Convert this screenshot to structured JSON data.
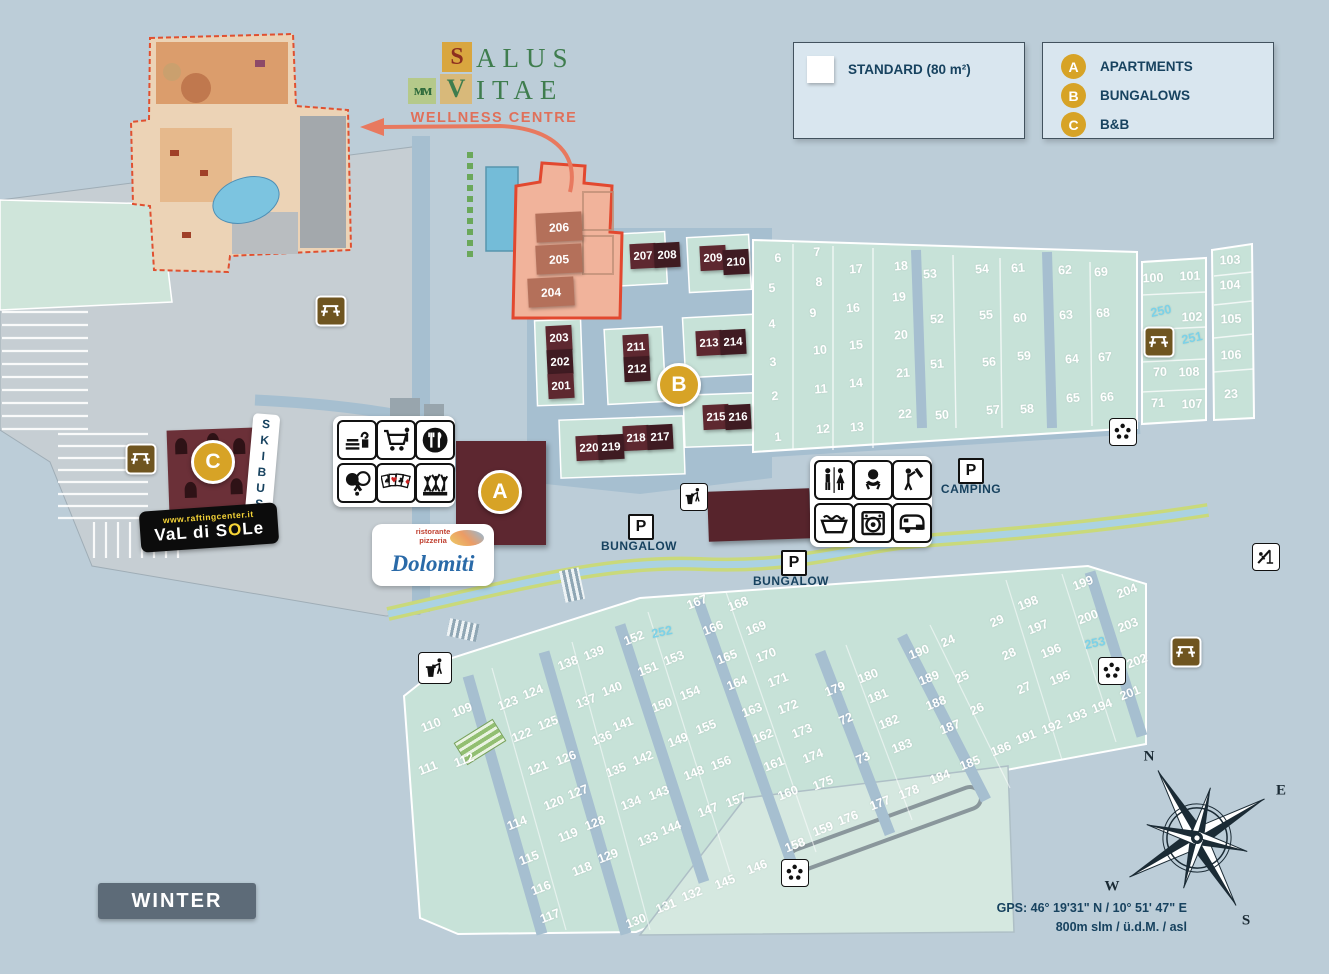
{
  "title": {
    "word1": "ALUS",
    "word2": "ITAE",
    "s_letter": "S",
    "v_letter": "V",
    "m_letter": "ᴍᴍ",
    "sub": "WELLNESS CENTRE"
  },
  "legend": {
    "standard_label": "STANDARD (80 m²)",
    "entries": [
      {
        "key": "A",
        "label": "APARTMENTS"
      },
      {
        "key": "B",
        "label": "BUNGALOWS"
      },
      {
        "key": "C",
        "label": "B&B"
      }
    ]
  },
  "markers": {
    "a": "A",
    "b": "B",
    "c": "C"
  },
  "labels": {
    "skibus": "SKIBUS",
    "camping": "CAMPING",
    "bungalow_left": "BUNGALOW",
    "bungalow_right": "BUNGALOW",
    "winter": "WINTER",
    "parking": "P"
  },
  "gps": {
    "line1": "GPS:  46° 19'31\" N / 10° 51' 47\" E",
    "line2": "800m slm / ü.d.M. / asl"
  },
  "brands": {
    "rafting_url": "www.raftingcenter.it",
    "rafting_name_pre": "VaL di S",
    "rafting_o": "O",
    "rafting_name_post": "Le",
    "restaurant_pre": "ristorante",
    "restaurant_pre2": "pizzeria",
    "restaurant_name": "Dolomiti"
  },
  "compass": {
    "n": "N",
    "e": "E",
    "s": "S",
    "w": "W"
  },
  "colors": {
    "accent_gold": "#d7a326",
    "building_dark": "#5e2830",
    "building_darker": "#3f1b22",
    "building_light": "#b4705a",
    "pitch_green": "#c7e2d8",
    "cyan_number": "#7bd2e8",
    "navy": "#17425f",
    "salmon_area": "#f1b39b",
    "red_outline": "#e2482f"
  },
  "service_icons": [
    "dishwashing",
    "market",
    "restaurant",
    "table-tennis",
    "playing-cards",
    "entertainment"
  ],
  "sanitary_icons": [
    "wc",
    "baby-room",
    "shower",
    "washing-sinks",
    "laundry",
    "camper-service"
  ],
  "map_icons": [
    {
      "type": "picnic-table",
      "x": 331,
      "y": 311
    },
    {
      "type": "picnic-table",
      "x": 141,
      "y": 459
    },
    {
      "type": "picnic-table",
      "x": 1159,
      "y": 342
    },
    {
      "type": "picnic-table",
      "x": 1186,
      "y": 652
    },
    {
      "type": "waste",
      "x": 435,
      "y": 668,
      "big": true
    },
    {
      "type": "waste",
      "x": 694,
      "y": 497
    },
    {
      "type": "recycle",
      "x": 1123,
      "y": 432
    },
    {
      "type": "recycle",
      "x": 1112,
      "y": 671
    },
    {
      "type": "recycle",
      "x": 795,
      "y": 873
    },
    {
      "type": "playground",
      "x": 1266,
      "y": 557
    }
  ],
  "buildings": {
    "wellness": [
      [
        "206",
        559,
        227
      ],
      [
        "205",
        559,
        259
      ],
      [
        "204",
        551,
        292
      ]
    ],
    "bungalows": [
      [
        "207",
        643,
        256,
        "a"
      ],
      [
        "208",
        667,
        255,
        "b"
      ],
      [
        "209",
        713,
        258,
        "a"
      ],
      [
        "210",
        736,
        262,
        "b"
      ],
      [
        "203",
        559,
        338,
        "a"
      ],
      [
        "202",
        560,
        362,
        "b"
      ],
      [
        "201",
        561,
        386,
        "a"
      ],
      [
        "211",
        636,
        347,
        "a"
      ],
      [
        "212",
        637,
        369,
        "b"
      ],
      [
        "213",
        709,
        343,
        "a"
      ],
      [
        "214",
        733,
        342,
        "b"
      ],
      [
        "215",
        716,
        417,
        "a"
      ],
      [
        "216",
        738,
        417,
        "b"
      ],
      [
        "218",
        636,
        438,
        "a"
      ],
      [
        "217",
        660,
        437,
        "b"
      ],
      [
        "220",
        589,
        448,
        "a"
      ],
      [
        "219",
        611,
        447,
        "b"
      ]
    ]
  },
  "pitch_groups": [
    {
      "id": "top",
      "rot": -4,
      "items": [
        [
          "6",
          778,
          258
        ],
        [
          "7",
          817,
          252
        ],
        [
          "17",
          856,
          269
        ],
        [
          "18",
          901,
          266
        ],
        [
          "53",
          930,
          274
        ],
        [
          "5",
          772,
          288
        ],
        [
          "8",
          819,
          282
        ],
        [
          "16",
          853,
          308
        ],
        [
          "19",
          899,
          297
        ],
        [
          "52",
          937,
          319
        ],
        [
          "4",
          772,
          324
        ],
        [
          "9",
          813,
          313
        ],
        [
          "15",
          856,
          345
        ],
        [
          "20",
          901,
          335
        ],
        [
          "3",
          773,
          362
        ],
        [
          "10",
          820,
          350
        ],
        [
          "14",
          856,
          383
        ],
        [
          "21",
          903,
          373
        ],
        [
          "51",
          937,
          364
        ],
        [
          "2",
          775,
          396
        ],
        [
          "11",
          821,
          389
        ],
        [
          "22",
          905,
          414
        ],
        [
          "50",
          942,
          415
        ],
        [
          "1",
          778,
          437
        ],
        [
          "12",
          823,
          429
        ],
        [
          "13",
          857,
          427
        ],
        [
          "54",
          982,
          269
        ],
        [
          "61",
          1018,
          268
        ],
        [
          "62",
          1065,
          270
        ],
        [
          "69",
          1101,
          272
        ],
        [
          "55",
          986,
          315
        ],
        [
          "60",
          1020,
          318
        ],
        [
          "63",
          1066,
          315
        ],
        [
          "68",
          1103,
          313
        ],
        [
          "56",
          989,
          362
        ],
        [
          "59",
          1024,
          356
        ],
        [
          "64",
          1072,
          359
        ],
        [
          "67",
          1105,
          357
        ],
        [
          "57",
          993,
          410
        ],
        [
          "58",
          1027,
          409
        ],
        [
          "65",
          1073,
          398
        ],
        [
          "66",
          1107,
          397
        ]
      ]
    },
    {
      "id": "right",
      "rot": -2,
      "items": [
        [
          "100",
          1153,
          278
        ],
        [
          "101",
          1190,
          276
        ],
        [
          "103",
          1230,
          260
        ],
        [
          "104",
          1230,
          285
        ],
        [
          "102",
          1192,
          317
        ],
        [
          "105",
          1231,
          319
        ],
        [
          "106",
          1231,
          355
        ],
        [
          "70",
          1160,
          372
        ],
        [
          "108",
          1189,
          372
        ],
        [
          "23",
          1231,
          394
        ],
        [
          "71",
          1158,
          403
        ],
        [
          "107",
          1192,
          404
        ]
      ]
    },
    {
      "id": "mid",
      "rot": -24,
      "items": [
        [
          "29",
          997,
          621
        ],
        [
          "28",
          1009,
          654
        ],
        [
          "27",
          1024,
          688
        ],
        [
          "26",
          977,
          709
        ],
        [
          "25",
          962,
          677
        ],
        [
          "24",
          948,
          641
        ],
        [
          "72",
          846,
          719
        ],
        [
          "73",
          863,
          758
        ]
      ]
    },
    {
      "id": "bottom",
      "rot": -21,
      "items": [
        [
          "109",
          462,
          710
        ],
        [
          "110",
          431,
          725
        ],
        [
          "111",
          428,
          768
        ],
        [
          "112",
          464,
          760
        ],
        [
          "114",
          517,
          823
        ],
        [
          "115",
          529,
          858
        ],
        [
          "116",
          541,
          888
        ],
        [
          "117",
          550,
          916
        ],
        [
          "118",
          582,
          869
        ],
        [
          "119",
          568,
          835
        ],
        [
          "120",
          554,
          803
        ],
        [
          "121",
          538,
          768
        ],
        [
          "122",
          522,
          735
        ],
        [
          "123",
          508,
          703
        ],
        [
          "124",
          533,
          692
        ],
        [
          "125",
          548,
          723
        ],
        [
          "126",
          566,
          758
        ],
        [
          "127",
          578,
          792
        ],
        [
          "128",
          595,
          823
        ],
        [
          "129",
          608,
          856
        ],
        [
          "130",
          636,
          921
        ],
        [
          "131",
          666,
          906
        ],
        [
          "132",
          692,
          894
        ],
        [
          "133",
          648,
          839
        ],
        [
          "134",
          631,
          803
        ],
        [
          "135",
          616,
          770
        ],
        [
          "136",
          602,
          738
        ],
        [
          "137",
          586,
          701
        ],
        [
          "138",
          568,
          663
        ],
        [
          "139",
          594,
          653
        ],
        [
          "140",
          612,
          689
        ],
        [
          "141",
          623,
          724
        ],
        [
          "142",
          643,
          758
        ],
        [
          "143",
          659,
          793
        ],
        [
          "144",
          671,
          828
        ],
        [
          "145",
          725,
          882
        ],
        [
          "146",
          757,
          867
        ],
        [
          "147",
          708,
          810
        ],
        [
          "148",
          694,
          773
        ],
        [
          "149",
          678,
          740
        ],
        [
          "150",
          662,
          705
        ],
        [
          "151",
          648,
          669
        ],
        [
          "152",
          634,
          638
        ],
        [
          "153",
          674,
          658
        ],
        [
          "154",
          690,
          693
        ],
        [
          "155",
          706,
          727
        ],
        [
          "156",
          721,
          763
        ],
        [
          "157",
          736,
          800
        ],
        [
          "158",
          795,
          845
        ],
        [
          "159",
          823,
          829
        ],
        [
          "160",
          788,
          793
        ],
        [
          "161",
          774,
          764
        ],
        [
          "162",
          763,
          736
        ],
        [
          "163",
          752,
          710
        ],
        [
          "164",
          737,
          683
        ],
        [
          "165",
          727,
          657
        ],
        [
          "166",
          713,
          628
        ],
        [
          "167",
          697,
          602
        ],
        [
          "168",
          738,
          604
        ],
        [
          "169",
          756,
          628
        ],
        [
          "170",
          766,
          655
        ],
        [
          "171",
          778,
          680
        ],
        [
          "172",
          788,
          707
        ],
        [
          "173",
          802,
          731
        ],
        [
          "174",
          813,
          756
        ],
        [
          "175",
          823,
          783
        ],
        [
          "176",
          848,
          818
        ],
        [
          "177",
          880,
          803
        ],
        [
          "178",
          909,
          792
        ],
        [
          "179",
          835,
          689
        ],
        [
          "180",
          868,
          676
        ],
        [
          "181",
          878,
          696
        ],
        [
          "182",
          889,
          722
        ],
        [
          "183",
          902,
          746
        ],
        [
          "184",
          940,
          777
        ],
        [
          "185",
          970,
          763
        ],
        [
          "186",
          1001,
          749
        ],
        [
          "187",
          950,
          727
        ],
        [
          "188",
          936,
          703
        ],
        [
          "189",
          929,
          678
        ],
        [
          "190",
          919,
          652
        ],
        [
          "191",
          1026,
          737
        ],
        [
          "192",
          1052,
          727
        ],
        [
          "193",
          1077,
          716
        ],
        [
          "194",
          1102,
          706
        ],
        [
          "195",
          1060,
          678
        ],
        [
          "196",
          1051,
          651
        ],
        [
          "197",
          1038,
          627
        ],
        [
          "198",
          1028,
          603
        ],
        [
          "199",
          1083,
          583
        ],
        [
          "200",
          1088,
          617
        ],
        [
          "201",
          1130,
          693
        ],
        [
          "202",
          1137,
          661
        ],
        [
          "203",
          1128,
          625
        ],
        [
          "204",
          1127,
          591
        ]
      ]
    }
  ],
  "special_pitches": [
    [
      "250",
      1161,
      311
    ],
    [
      "251",
      1192,
      338
    ],
    [
      "252",
      662,
      632
    ],
    [
      "253",
      1095,
      643
    ]
  ]
}
